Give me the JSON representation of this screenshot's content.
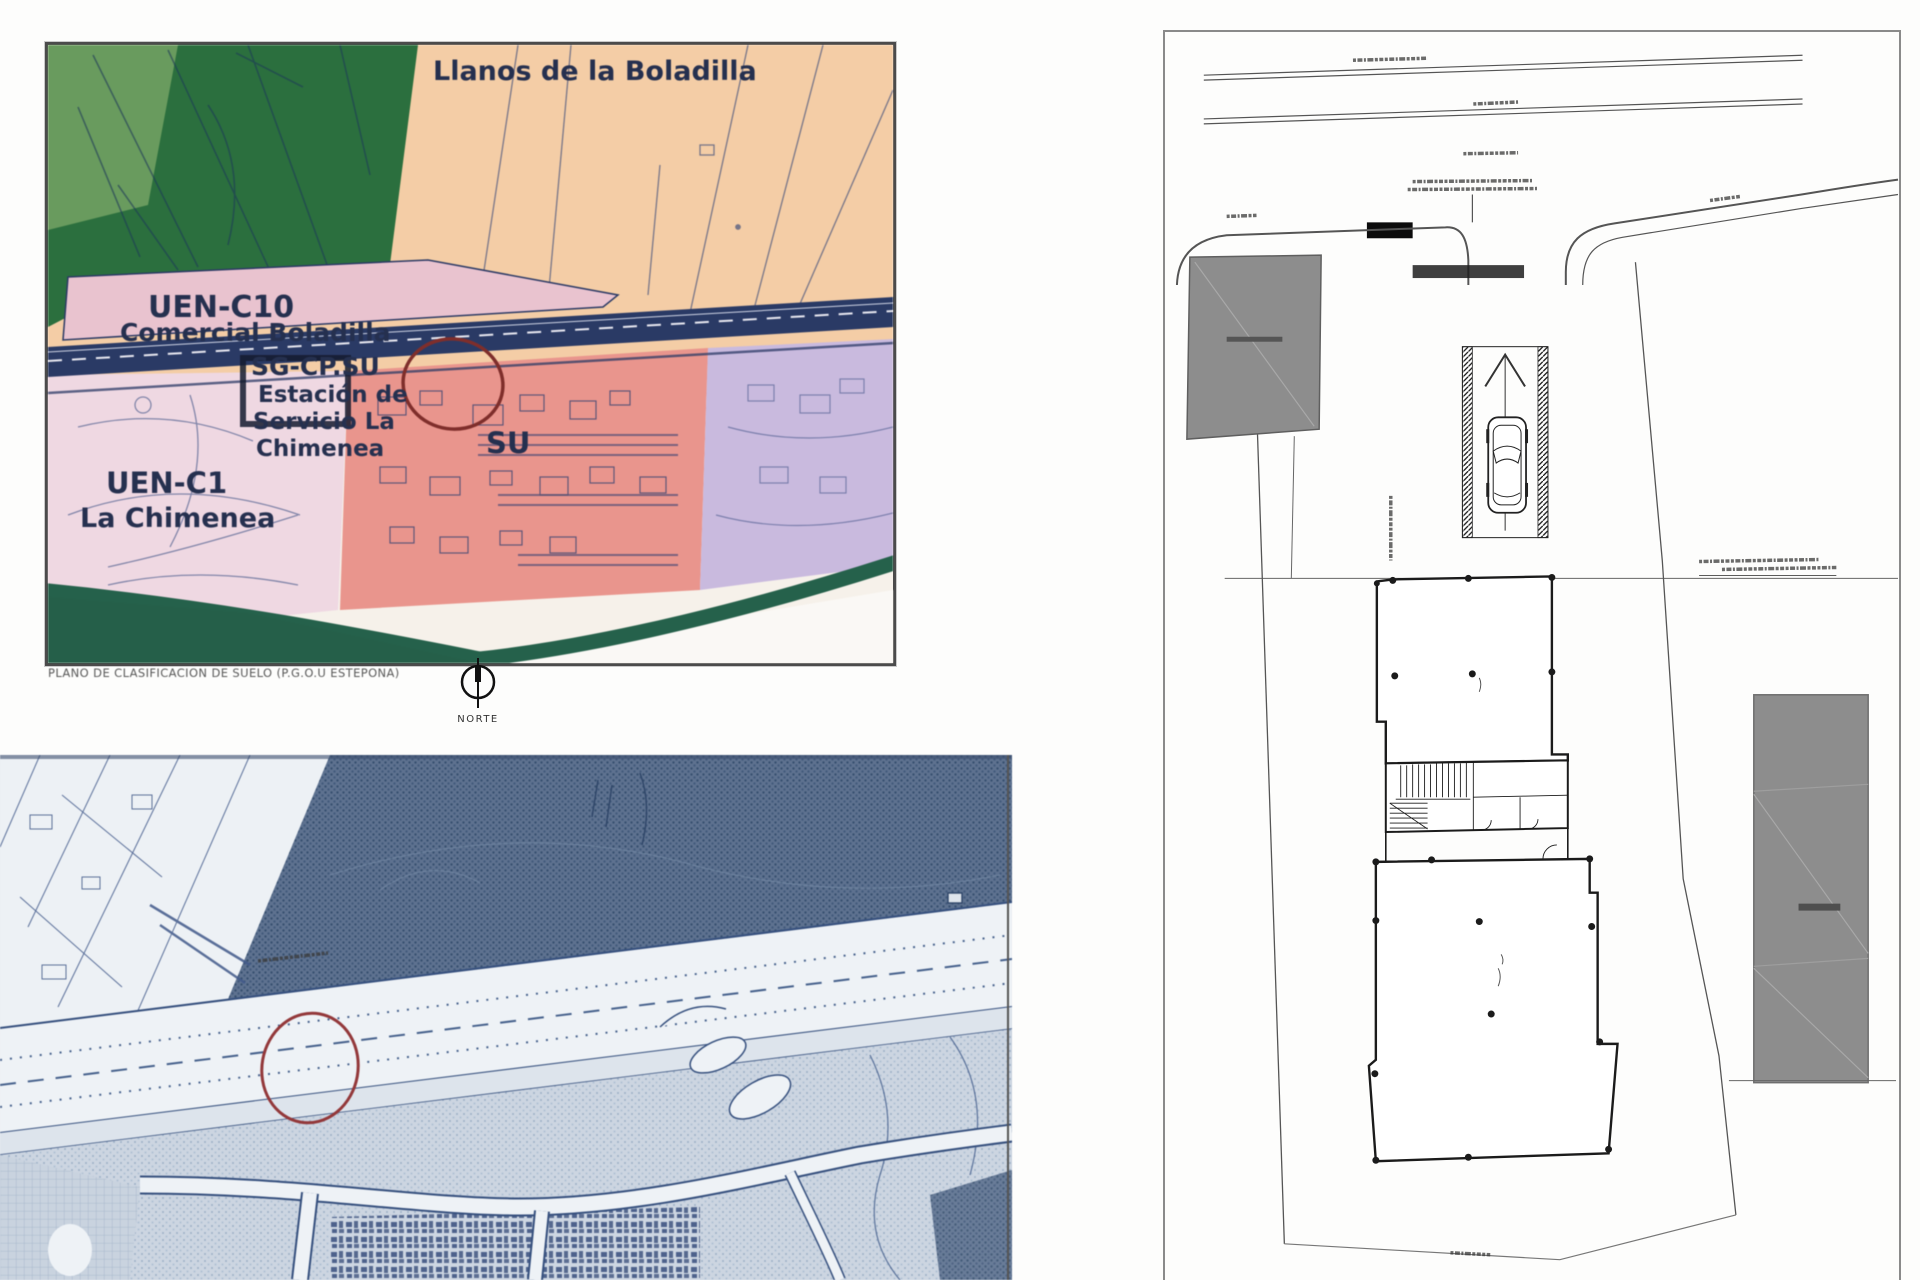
{
  "page": {
    "background": "#fdfdfc"
  },
  "zoning_map": {
    "title": "Llanos de la Boladilla",
    "caption": "PLANO DE CLASIFICACION DE SUELO (P.G.O.U ESTEPONA)",
    "north_label": "NORTE",
    "zones": {
      "uen_c10": {
        "code": "UEN-C10",
        "name": "Comercial Boladilla"
      },
      "sg_cp": {
        "code": "SG-CP.SU",
        "name_lines": [
          "Estación de",
          "Servicio La",
          "Chimenea"
        ]
      },
      "su": {
        "code": "SU"
      },
      "uen_c1": {
        "code": "UEN-C1",
        "name": "La Chimenea"
      }
    },
    "colors": {
      "rural_green": "#2d6e3f",
      "plains_peach": "#f2cda8",
      "commercial_pink": "#e8c3cf",
      "urban_salmon": "#e6968e",
      "residential_lavender": "#c9badd",
      "road_navy": "#2b3a63",
      "site_circle_red": "#7c2f2c",
      "label_ink": "#26304e"
    }
  },
  "cadastral_map": {
    "site_circle_color": "#93383a",
    "ink_color": "#36507e",
    "illegible_annotations": [
      "road-kilometer-label"
    ]
  },
  "site_plan": {
    "line_color": "#2a2a2a",
    "building_fill": "#8d8d8d",
    "sign_fill": "#0c0c0c",
    "illegible_annotations": [
      "upper-road-label",
      "median-road-label",
      "center-note",
      "sign-note-line-1",
      "sign-note-line-2",
      "left-curb-label",
      "right-curb-label",
      "boundary-vertical-note",
      "alignment-note",
      "bottom-boundary-label",
      "left-building-label",
      "right-building-label"
    ]
  }
}
